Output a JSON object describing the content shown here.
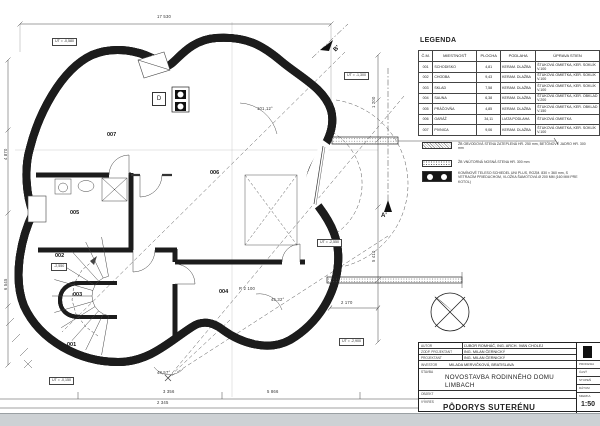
{
  "legend": {
    "title": "LEGENDA",
    "table": {
      "headers": [
        "Č.M.",
        "MIESTNOSŤ",
        "PLOCHA",
        "PODLAHA",
        "ÚPRAVA STIEN"
      ],
      "rows": [
        {
          "num": "001",
          "name": "SCHODISKO",
          "area": "4,81",
          "floor": "KERAM. DLAŽBA",
          "walls": "ŠTUKOVÁ OMIETKA, KER. SOKLÍK V.100"
        },
        {
          "num": "002",
          "name": "CHODBA",
          "area": "9,43",
          "floor": "KERAM. DLAŽBA",
          "walls": "ŠTUKOVÁ OMIETKA, KER. SOKLÍK V.100"
        },
        {
          "num": "003",
          "name": "SKLAD",
          "area": "7,58",
          "floor": "KERAM. DLAŽBA",
          "walls": "ŠTUKOVÁ OMIETKA, KER. SOKLÍK V.100"
        },
        {
          "num": "004",
          "name": "SAUNA",
          "area": "6,38",
          "floor": "KERAM. DLAŽBA",
          "walls": "ŠTUKOVÁ OMIETKA, KER. OBKLAD V.200"
        },
        {
          "num": "005",
          "name": "PRÁČOVŇA",
          "area": "4,85",
          "floor": "KERAM. DLAŽBA",
          "walls": "ŠTUKOVÁ OMIETKA, KER. OBKLAD V.150"
        },
        {
          "num": "006",
          "name": "GARÁŽ",
          "area": "34,11",
          "floor": "LIATA PODLAHA",
          "walls": "ŠTUKOVÁ OMIETKA"
        },
        {
          "num": "007",
          "name": "PIVNICA",
          "area": "9,06",
          "floor": "KERAM. DLAŽBA",
          "walls": "ŠTUKOVÁ OMIETKA, KER. SOKLÍK V.100"
        }
      ]
    },
    "notes": [
      {
        "icon": "exterior-wall-hatch",
        "text": "ŽB OBVODOVÁ STENA ZATEPLENÁ HR. 250 mm, BETÓNOVÉ JADRO HR. 300 mm"
      },
      {
        "icon": "interior-wall-hatch",
        "text": "ŽB VNÚTORNÁ NOSNÁ STENA HR. 300 mm"
      },
      {
        "icon": "chimney-symbol",
        "text": "KOMÍNOVÉ TELESO SCHIEDEL UNI PLUS, ROZM. 830 × 360 mm, S VETRACÍM PRIEDUCHOM, VLOŽKA ŠAMOTOVÁ Ø 200 MM (160 MM PRE KOTOL)"
      }
    ]
  },
  "titleblock": {
    "rows": [
      {
        "label": "AUTOR",
        "value": "ĽUBOR ROMHÁČ, ING. ARCH. IVAN CHOLEJ"
      },
      {
        "label": "ZODP. PROJEKTANT",
        "value": "ING. MILAN ČERNICKÝ"
      },
      {
        "label": "PROJEKTANT",
        "value": "ING. MILAN ČERNICKÝ"
      },
      {
        "label": "INVESTOR",
        "value": "MILADA MERVIČKOVÁ, BRATISLAVA"
      }
    ],
    "stavba_label": "STAVBA",
    "stavba_line1": "NOVOSTAVBA RODINNÉHO DOMU",
    "stavba_line2": "LIMBACH",
    "objekt_label": "OBJEKT",
    "vykres_label": "VÝKRES",
    "vykres_value": "PÔDORYS SUTERÉNU",
    "side_labels": [
      "PROFESIA",
      "ČASŤ",
      "STUPEŇ",
      "DÁTUM",
      "MIERKA"
    ],
    "scale_value": "1:50"
  },
  "plan": {
    "rooms": [
      "001",
      "002",
      "003",
      "004",
      "005",
      "006",
      "007"
    ],
    "ut_labels": [
      "UT = -0,580",
      "UT = -1,300",
      "UT = -2,550",
      "UT = -2,900",
      "UT = -0,150"
    ],
    "level_002": "-2,550",
    "section_markers": [
      "A'",
      "B'"
    ],
    "door_label": "D",
    "dims": [
      "17 530",
      "48,57°",
      "3 356",
      "5 866",
      "2 345",
      "101,12°",
      "45,32°",
      "R 2 100",
      "2 170",
      "1 200",
      "5 410",
      "4 870",
      "6 545"
    ]
  }
}
